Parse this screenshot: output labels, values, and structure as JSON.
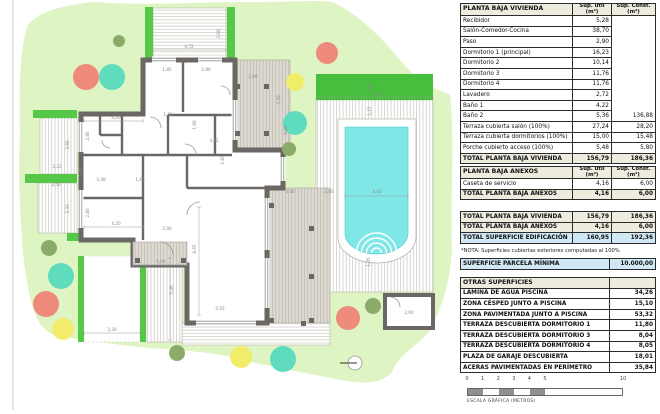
{
  "colors": {
    "lawn": "#def4c2",
    "hedge": "#55c947",
    "hedge_dark": "#46be3e",
    "wall": "#6b6764",
    "water": "#7fe8e6",
    "deck_tint": "#dedad2",
    "salmon": "#ee8a7c",
    "teal": "#5fdcbd",
    "yellow": "#f1ed6a",
    "olive": "#8cab69",
    "table_header": "#eeebdf",
    "table_blue": "#cfe8f4",
    "scale_gray": "#8f8f8f"
  },
  "plan": {
    "dims": [
      {
        "t": "4,72",
        "x": 189,
        "y": 48,
        "v": 0
      },
      {
        "t": "2,00",
        "x": 220,
        "y": 34,
        "v": 1
      },
      {
        "t": "1,85",
        "x": 167,
        "y": 71,
        "v": 0
      },
      {
        "t": "2,80",
        "x": 206,
        "y": 71,
        "v": 0
      },
      {
        "t": "2,98",
        "x": 253,
        "y": 78,
        "v": 0
      },
      {
        "t": "4,70",
        "x": 280,
        "y": 100,
        "v": 1
      },
      {
        "t": "6,00",
        "x": 287,
        "y": 130,
        "v": 1
      },
      {
        "t": "1,93",
        "x": 168,
        "y": 116,
        "v": 0
      },
      {
        "t": "1,60",
        "x": 196,
        "y": 125,
        "v": 1
      },
      {
        "t": "3,62",
        "x": 214,
        "y": 142,
        "v": 0
      },
      {
        "t": "2,85",
        "x": 224,
        "y": 160,
        "v": 1
      },
      {
        "t": "4,20",
        "x": 116,
        "y": 119,
        "v": 0
      },
      {
        "t": "2,80",
        "x": 89,
        "y": 136,
        "v": 1
      },
      {
        "t": "4,20",
        "x": 116,
        "y": 225,
        "v": 0
      },
      {
        "t": "2,80",
        "x": 89,
        "y": 213,
        "v": 1
      },
      {
        "t": "2,22",
        "x": 57,
        "y": 168,
        "v": 0
      },
      {
        "t": "3,60",
        "x": 69,
        "y": 145,
        "v": 1
      },
      {
        "t": "2,50",
        "x": 56,
        "y": 186,
        "v": 0
      },
      {
        "t": "3,33",
        "x": 69,
        "y": 209,
        "v": 1
      },
      {
        "t": "2,48",
        "x": 101,
        "y": 181,
        "v": 0
      },
      {
        "t": "1,60",
        "x": 140,
        "y": 181,
        "v": 0
      },
      {
        "t": "1,70",
        "x": 82,
        "y": 172,
        "v": 1
      },
      {
        "t": "2,00",
        "x": 167,
        "y": 230,
        "v": 0
      },
      {
        "t": "5,00",
        "x": 161,
        "y": 263,
        "v": 0
      },
      {
        "t": "8,65",
        "x": 196,
        "y": 249,
        "v": 1
      },
      {
        "t": "5,46",
        "x": 173,
        "y": 290,
        "v": 1
      },
      {
        "t": "5,65",
        "x": 220,
        "y": 310,
        "v": 0
      },
      {
        "t": "3,30",
        "x": 112,
        "y": 331,
        "v": 0
      },
      {
        "t": "2,00",
        "x": 371,
        "y": 88,
        "v": 1
      },
      {
        "t": "7,64",
        "x": 378,
        "y": 96,
        "v": 0
      },
      {
        "t": "1,15",
        "x": 371,
        "y": 111,
        "v": 1
      },
      {
        "t": "4,00",
        "x": 377,
        "y": 193,
        "v": 0
      },
      {
        "t": "2,00",
        "x": 329,
        "y": 193,
        "v": 0
      },
      {
        "t": "3,00",
        "x": 290,
        "y": 193,
        "v": 0
      },
      {
        "t": "1,05",
        "x": 370,
        "y": 262,
        "v": 1
      },
      {
        "t": "2,60",
        "x": 409,
        "y": 314,
        "v": 0
      }
    ],
    "trees": [
      {
        "x": 119,
        "y": 41,
        "r": 6,
        "c": "olive"
      },
      {
        "x": 86,
        "y": 77,
        "r": 13,
        "c": "salmon"
      },
      {
        "x": 112,
        "y": 77,
        "r": 13,
        "c": "teal"
      },
      {
        "x": 327,
        "y": 53,
        "r": 11,
        "c": "salmon"
      },
      {
        "x": 295,
        "y": 82,
        "r": 9,
        "c": "yellow"
      },
      {
        "x": 295,
        "y": 123,
        "r": 12,
        "c": "teal"
      },
      {
        "x": 289,
        "y": 149,
        "r": 7,
        "c": "olive"
      },
      {
        "x": 49,
        "y": 248,
        "r": 8,
        "c": "olive"
      },
      {
        "x": 61,
        "y": 276,
        "r": 13,
        "c": "teal"
      },
      {
        "x": 46,
        "y": 304,
        "r": 13,
        "c": "salmon"
      },
      {
        "x": 63,
        "y": 329,
        "r": 11,
        "c": "yellow"
      },
      {
        "x": 177,
        "y": 353,
        "r": 8,
        "c": "olive"
      },
      {
        "x": 348,
        "y": 318,
        "r": 12,
        "c": "salmon"
      },
      {
        "x": 373,
        "y": 306,
        "r": 8,
        "c": "olive"
      },
      {
        "x": 241,
        "y": 357,
        "r": 11,
        "c": "yellow"
      },
      {
        "x": 283,
        "y": 359,
        "r": 13,
        "c": "teal"
      }
    ],
    "hedges": [
      {
        "x": 145,
        "y": 7,
        "w": 8,
        "h": 53,
        "dark": 0
      },
      {
        "x": 227,
        "y": 7,
        "w": 8,
        "h": 53,
        "dark": 0
      },
      {
        "x": 33,
        "y": 110,
        "w": 44,
        "h": 8,
        "dark": 0
      },
      {
        "x": 25,
        "y": 174,
        "w": 52,
        "h": 9,
        "dark": 0
      },
      {
        "x": 67,
        "y": 233,
        "w": 36,
        "h": 8,
        "dark": 0
      },
      {
        "x": 78,
        "y": 256,
        "w": 6,
        "h": 86,
        "dark": 0
      },
      {
        "x": 140,
        "y": 267,
        "w": 6,
        "h": 75,
        "dark": 0
      },
      {
        "x": 316,
        "y": 74,
        "w": 117,
        "h": 26,
        "dark": 1
      }
    ]
  },
  "tables": {
    "vivienda": {
      "header": {
        "name": "PLANTA BAJA VIVIENDA",
        "cols": [
          {
            "l": "Sup. útil",
            "u": "(m²)"
          },
          {
            "l": "Sup. Const.",
            "u": "(m²)"
          }
        ]
      },
      "rows": [
        [
          "Recibidor",
          "5,28",
          ""
        ],
        [
          "Salón-Comedor-Cocina",
          "38,70",
          ""
        ],
        [
          "Paso",
          "2,90",
          ""
        ],
        [
          "Dormitorio 1 (principal)",
          "16,23",
          ""
        ],
        [
          "Dormitorio 2",
          "10,14",
          ""
        ],
        [
          "Dormitorio 3",
          "11,76",
          ""
        ],
        [
          "Dormitorio 4",
          "11,76",
          ""
        ],
        [
          "Lavadero",
          "2,72",
          ""
        ],
        [
          "Baño 1",
          "4,22",
          ""
        ],
        [
          "Baño 2",
          "5,36",
          "136,88"
        ],
        [
          "Terraza cubierta salón (100%)",
          "27,24",
          "28,20"
        ],
        [
          "Terraza cubierta dormitorios (100%)",
          "15,00",
          "15,48"
        ],
        [
          "Porche cubierto acceso (100%)",
          "5,48",
          "5,80"
        ]
      ],
      "total": [
        "TOTAL PLANTA BAJA VIVIENDA",
        "156,79",
        "186,36"
      ]
    },
    "anexos": {
      "header": {
        "name": "PLANTA BAJA ANEXOS",
        "cols": [
          {
            "l": "Sup. útil",
            "u": "(m²)"
          },
          {
            "l": "Sup. Const.",
            "u": "(m²)"
          }
        ]
      },
      "rows": [
        [
          "Caseta de servicio",
          "4,16",
          "6,00"
        ]
      ],
      "total": [
        "TOTAL PLANTA BAJA ANEXOS",
        "4,16",
        "6,00"
      ]
    },
    "totales": {
      "rows": [
        {
          "c": [
            "TOTAL PLANTA BAJA VIVIENDA",
            "156,79",
            "186,36"
          ],
          "cls": "total"
        },
        {
          "c": [
            "TOTAL PLANTA BAJA ANEXOS",
            "4,16",
            "6,00"
          ],
          "cls": "total"
        },
        {
          "c": [
            "TOTAL SUPERFICIE EDIFICACIÓN",
            "160,95",
            "192,36"
          ],
          "cls": "blue"
        }
      ]
    },
    "nota": "*NOTA: Superficies cubiertas exteriores computadas al 100%",
    "parcela": {
      "name": "SUPERFICIE PARCELA MÍNIMA",
      "value": "10.000,00"
    },
    "otras": {
      "header": "OTRAS SUPERFICIES",
      "rows": [
        [
          "LÁMINA DE AGUA PISCINA",
          "34,26"
        ],
        [
          "ZONA CÉSPED JUNTO A PISCINA",
          "15,10"
        ],
        [
          "ZONA PAVIMENTADA JUNTO A PISCINA",
          "53,32"
        ],
        [
          "TERRAZA DESCUBIERTA DORMITORIO 1",
          "11,80"
        ],
        [
          "TERRAZA DESCUBIERTA DORMITORIO 3",
          "8,04"
        ],
        [
          "TERRAZA DESCUBIERTA DORMITORIO 4",
          "8,05"
        ],
        [
          "PLAZA DE GARAJE DESCUBIERTA",
          "18,01"
        ],
        [
          "ACERAS PAVIMENTADAS EN PERÍMETRO",
          "35,84"
        ]
      ]
    }
  },
  "scale": {
    "numbers": [
      {
        "t": "0",
        "x": 0
      },
      {
        "t": "1",
        "x": 15.6
      },
      {
        "t": "2",
        "x": 31.2
      },
      {
        "t": "3",
        "x": 46.8
      },
      {
        "t": "4",
        "x": 62.4
      },
      {
        "t": "5",
        "x": 78
      },
      {
        "t": "10",
        "x": 156
      }
    ],
    "segments": [
      {
        "w": 15.6,
        "fill": "gray"
      },
      {
        "w": 15.6,
        "fill": "white"
      },
      {
        "w": 15.6,
        "fill": "gray"
      },
      {
        "w": 15.6,
        "fill": "white"
      },
      {
        "w": 15.6,
        "fill": "gray"
      },
      {
        "w": 78,
        "fill": "white"
      }
    ],
    "label": "ESCALA GRÁFICA (METROS)"
  }
}
